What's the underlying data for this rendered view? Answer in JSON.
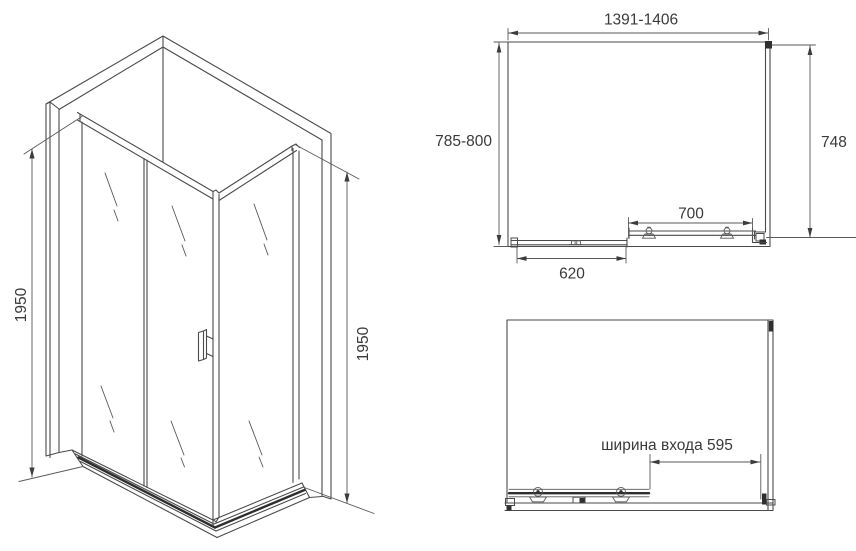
{
  "drawing": {
    "title": "shower-enclosure-technical-drawing",
    "background": "#ffffff",
    "line_color": "#4a4a4a",
    "text_color": "#3a3a3a",
    "isometric_view": {
      "height_left": "1950",
      "height_right": "1950"
    },
    "top_view": {
      "overall_width": "1391-1406",
      "overall_depth": "785-800",
      "side_panel_depth": "748",
      "door_travel": "700",
      "fixed_panel_width": "620"
    },
    "front_view": {
      "entrance_width_label": "ширина входа 595"
    }
  }
}
